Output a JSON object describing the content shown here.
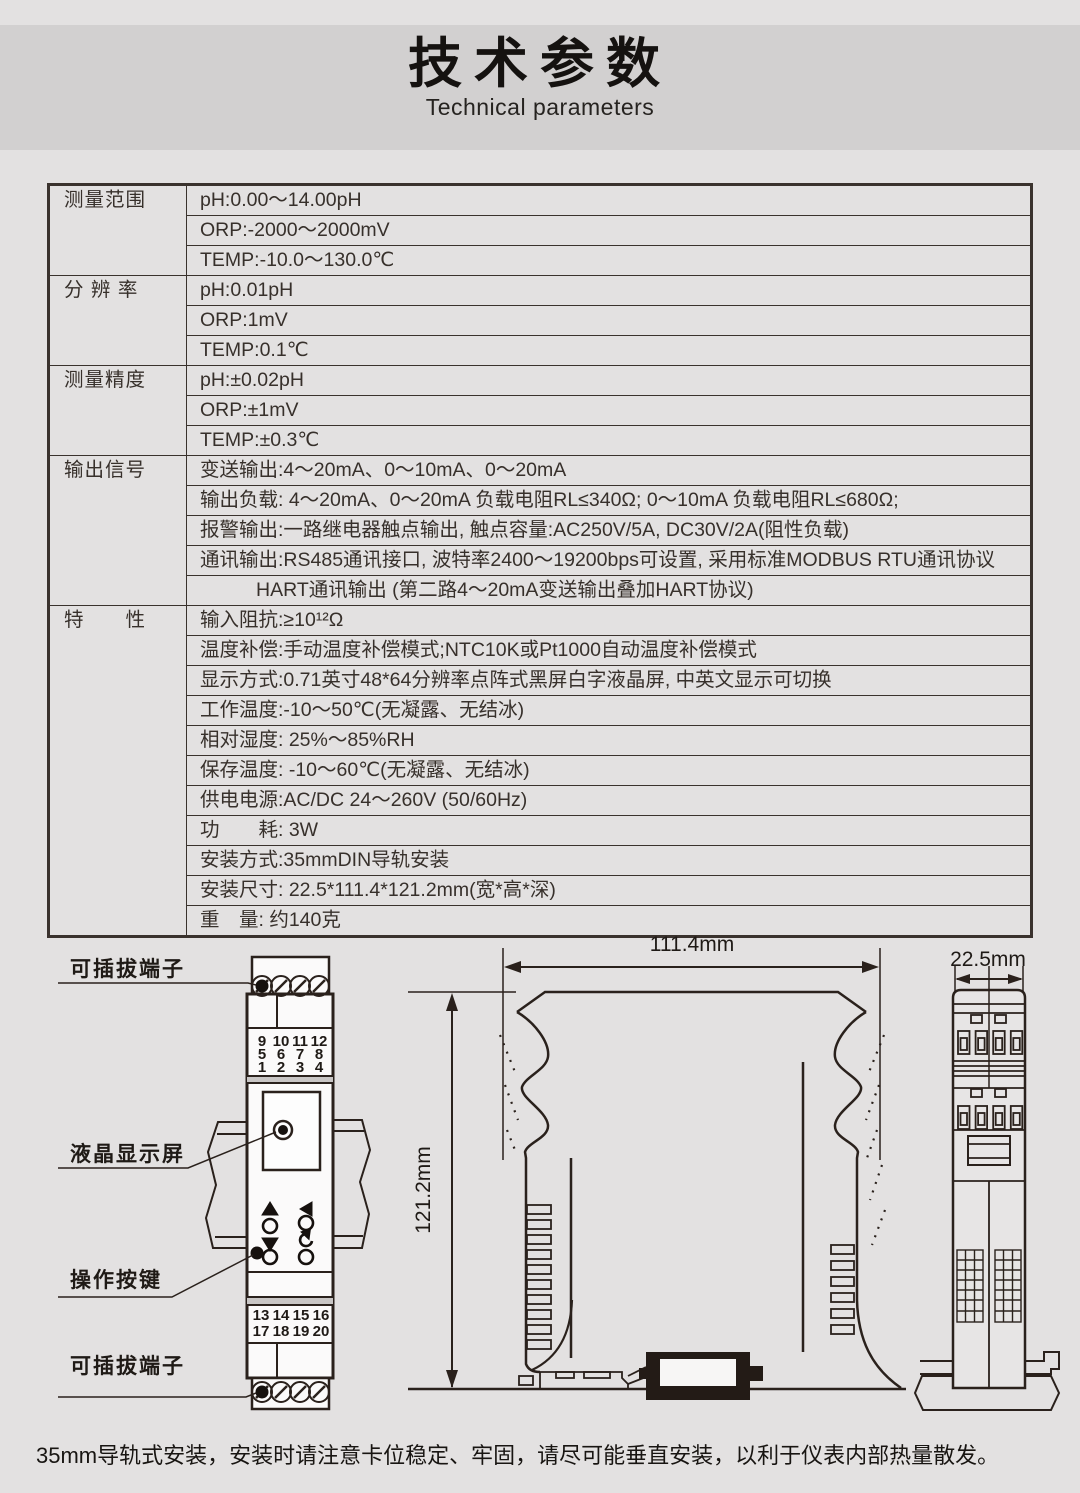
{
  "header": {
    "title": "技术参数",
    "subtitle": "Technical parameters"
  },
  "table": {
    "groups": [
      {
        "label": "测量范围",
        "rows": [
          "pH:0.00～14.00pH",
          "ORP:-2000～2000mV",
          "TEMP:-10.0～130.0℃"
        ]
      },
      {
        "label": "分 辨 率",
        "rows": [
          "pH:0.01pH",
          "ORP:1mV",
          "TEMP:0.1℃"
        ]
      },
      {
        "label": "测量精度",
        "rows": [
          "pH:±0.02pH",
          "ORP:±1mV",
          "TEMP:±0.3℃"
        ]
      },
      {
        "label": "输出信号",
        "rows": [
          "变送输出:4～20mA、0～10mA、0～20mA",
          "输出负载: 4～20mA、0～20mA 负载电阻RL≤340Ω; 0～10mA 负载电阻RL≤680Ω;",
          "报警输出:一路继电器触点输出, 触点容量:AC250V/5A, DC30V/2A(阻性负载)",
          "通讯输出:RS485通讯接口, 波特率2400～19200bps可设置, 采用标准MODBUS RTU通讯协议",
          "HART通讯输出 (第二路4～20mA变送输出叠加HART协议)"
        ]
      },
      {
        "label": "特　　性",
        "rows": [
          "输入阻抗:≥10¹²Ω",
          "温度补偿:手动温度补偿模式;NTC10K或Pt1000自动温度补偿模式",
          "显示方式:0.71英寸48*64分辨率点阵式黑屏白字液晶屏, 中英文显示可切换",
          "工作温度:-10～50℃(无凝露、无结冰)",
          "相对湿度: 25%～85%RH",
          "保存温度: -10～60℃(无凝露、无结冰)",
          "供电电源:AC/DC 24～260V (50/60Hz)",
          "功　　耗: 3W",
          "安装方式:35mmDIN导轨安装",
          "安装尺寸: 22.5*111.4*121.2mm(宽*高*深)",
          "重　量: 约140克"
        ]
      }
    ]
  },
  "diagram": {
    "front": {
      "label_terminal_top": "可插拔端子",
      "label_lcd": "液晶显示屏",
      "label_buttons": "操作按键",
      "label_terminal_bottom": "可插拔端子",
      "terminals_top": [
        [
          "9",
          "10",
          "11",
          "12"
        ],
        [
          "5",
          "6",
          "7",
          "8"
        ],
        [
          "1",
          "2",
          "3",
          "4"
        ]
      ],
      "terminals_bottom": [
        [
          "13",
          "14",
          "15",
          "16"
        ],
        [
          "17",
          "18",
          "19",
          "20"
        ]
      ]
    },
    "side": {
      "dim_width": "111.4mm",
      "dim_height": "121.2mm"
    },
    "end": {
      "dim_depth": "22.5mm"
    }
  },
  "footer": {
    "note": "35mm导轨式安装，安装时请注意卡位稳定、牢固，请尽可能垂直安装，以利于仪表内部热量散发。"
  },
  "colors": {
    "page_bg": "#e3e1e1",
    "band_bg": "#d2d0d0",
    "table_ink": "#37302b",
    "line_ink": "#2a211c",
    "terminal_red": "#dd3c22"
  }
}
